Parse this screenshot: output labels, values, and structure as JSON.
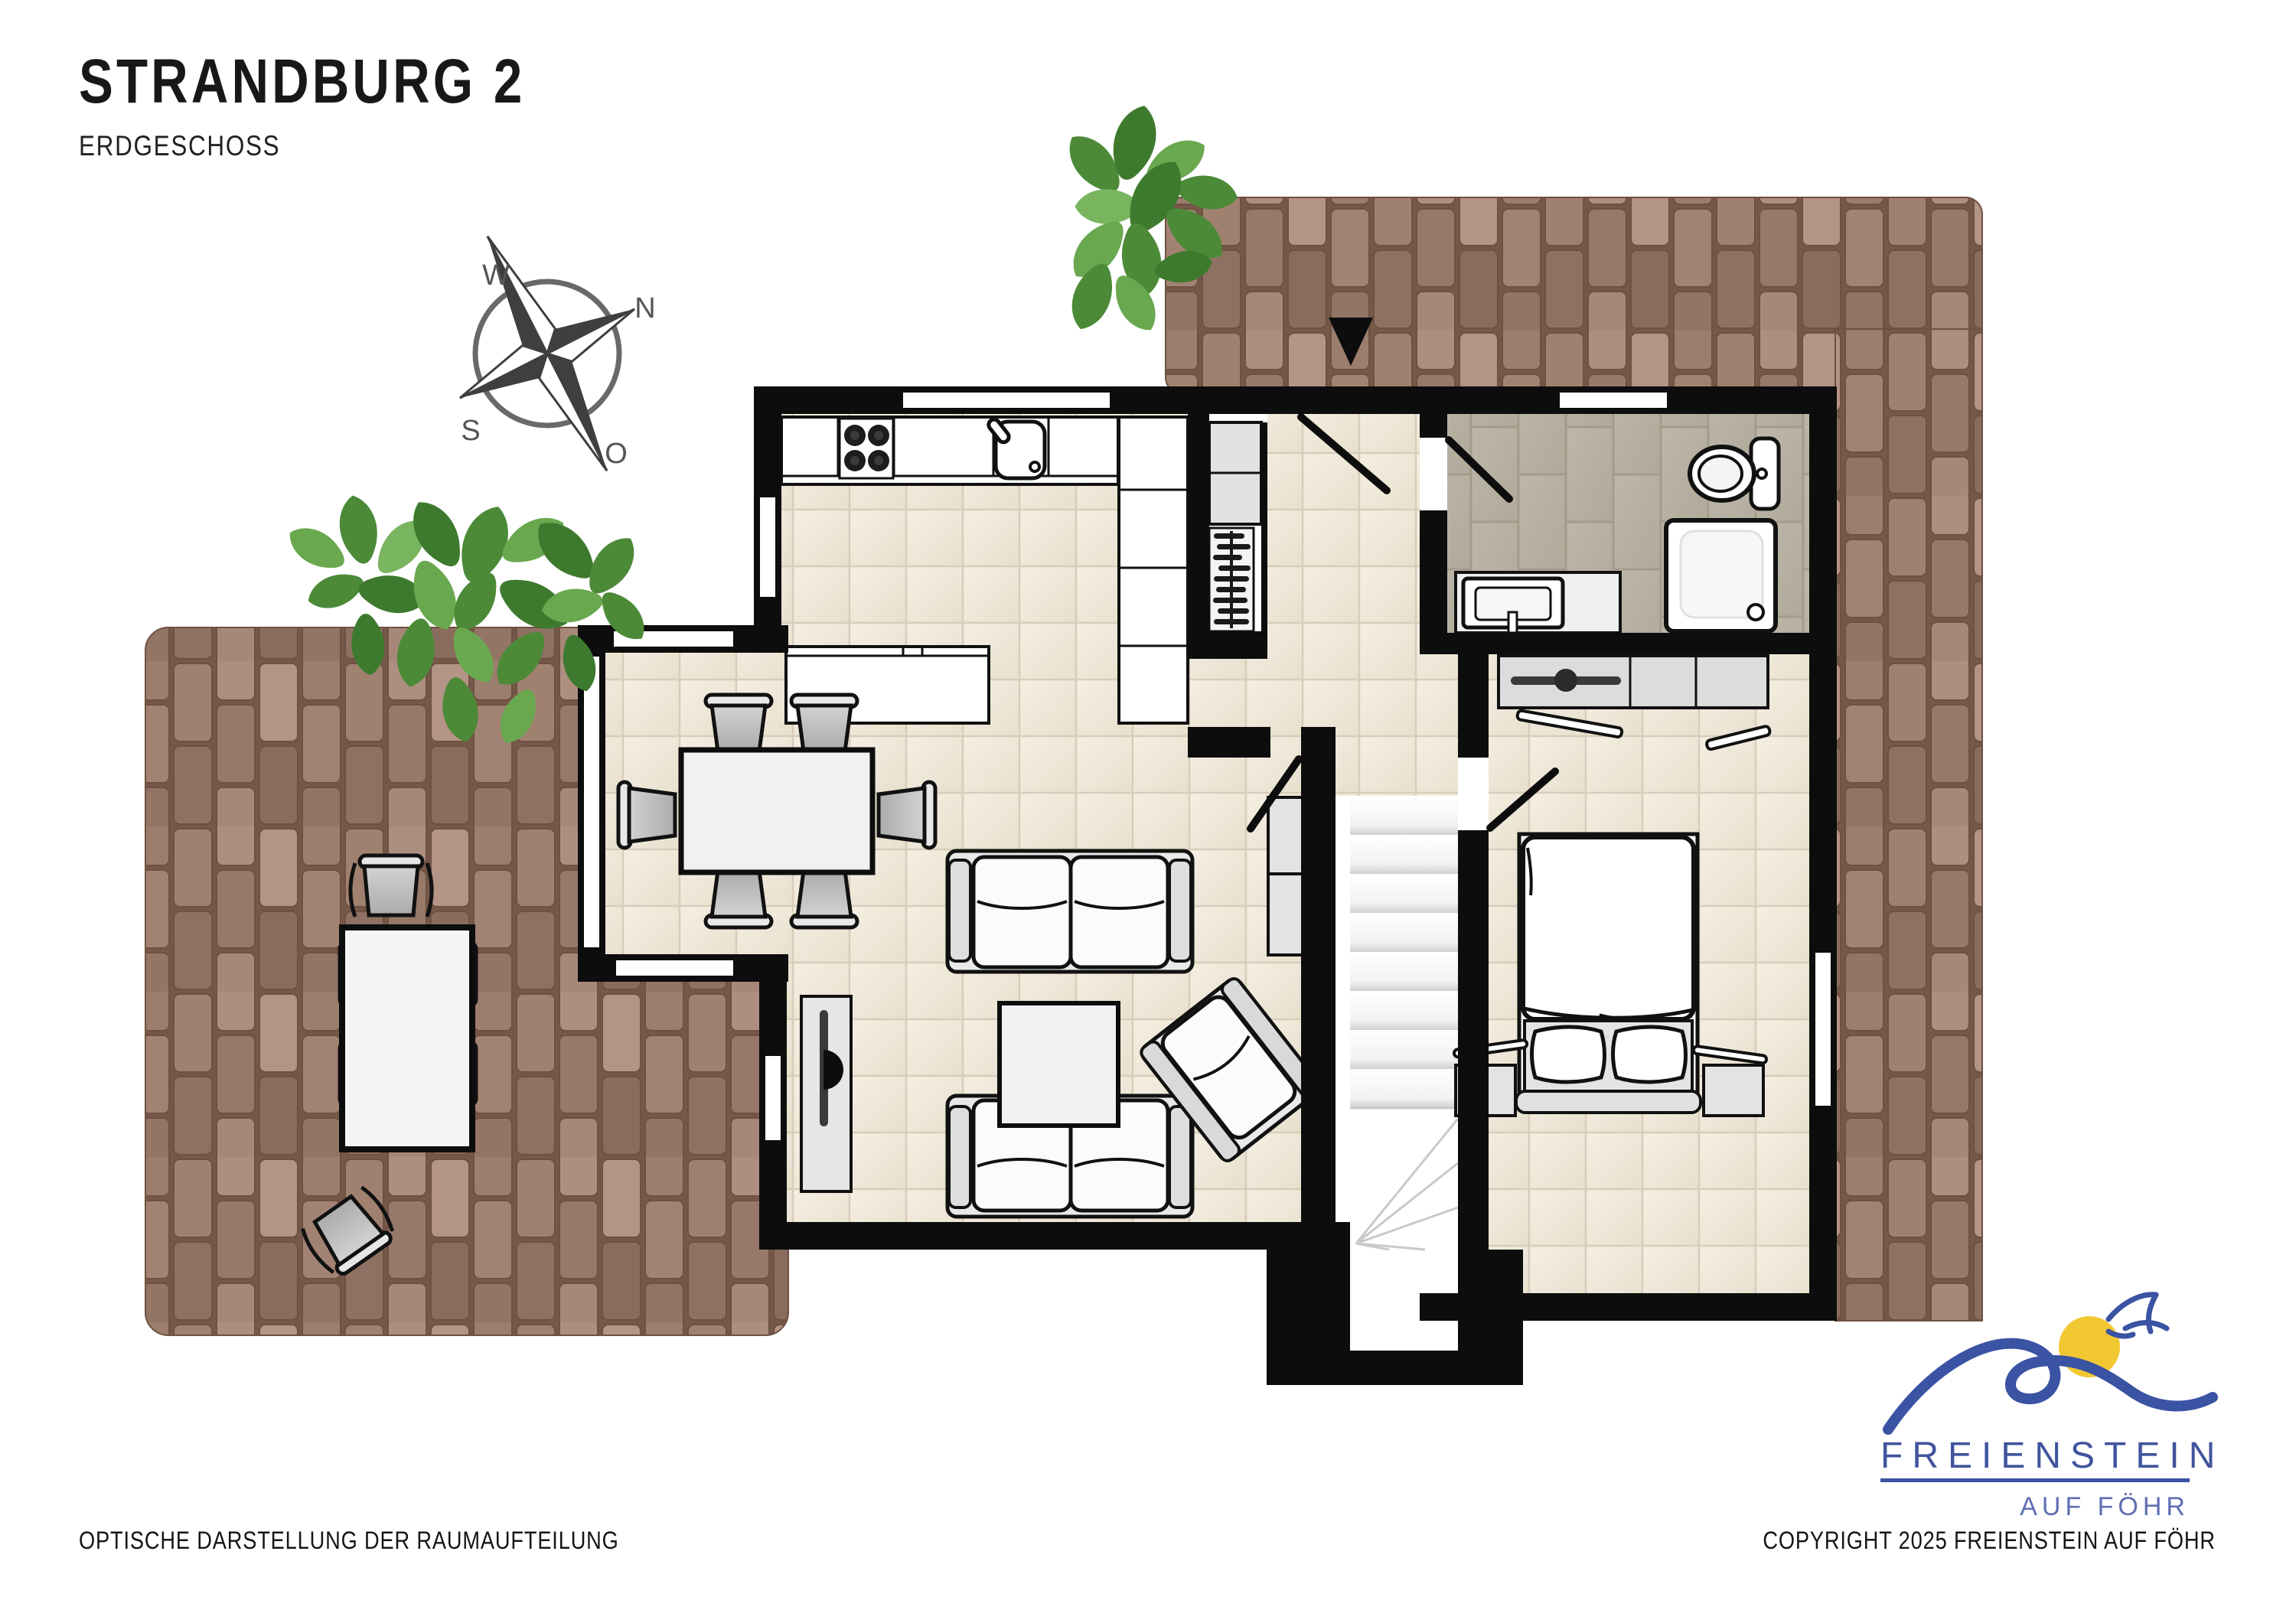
{
  "title": {
    "main": "STRANDBURG 2",
    "subtitle": "ERDGESCHOSS"
  },
  "compass": {
    "west": "W",
    "north": "N",
    "south": "S",
    "east": "O"
  },
  "footer": {
    "left": "OPTISCHE DARSTELLUNG DER RAUMAUFTEILUNG",
    "right": "COPYRIGHT 2025 FREIENSTEIN AUF FÖHR"
  },
  "logo": {
    "brand": "FREIENSTEIN",
    "tagline": "AUF FÖHR"
  },
  "colors": {
    "wall": "#0d0d0d",
    "floor_tile": "#f0e9db",
    "floor_joint": "#d8cdb9",
    "bath_tile": "#b9b3a5",
    "bath_joint": "#a49c8b",
    "brick_joint": "#755848",
    "stair_shade": "#d8d8d8",
    "furniture_outline": "#111111",
    "furniture_gray": "#dcdcdc",
    "plant_green_dark": "#3e7a2e",
    "plant_green_mid": "#4c8a38",
    "plant_green_light": "#6aa84f",
    "logo_blue": "#3b53a3",
    "logo_blue_light": "#5f6fb3",
    "logo_yellow": "#f2c832",
    "compass_gray": "#4f4f4f"
  }
}
